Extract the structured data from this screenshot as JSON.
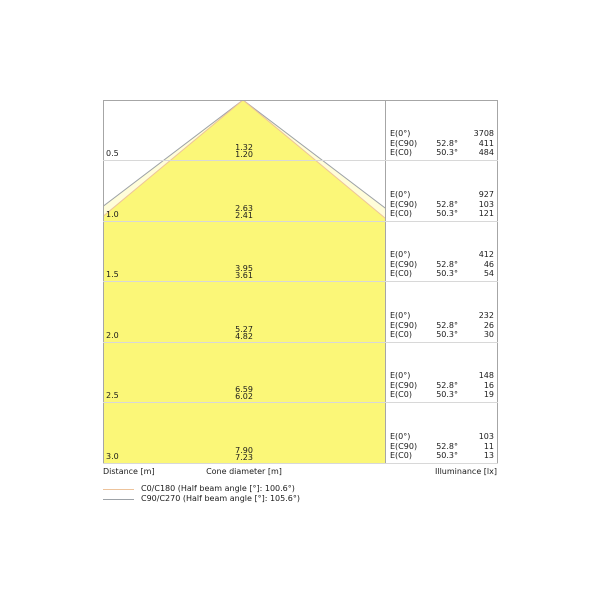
{
  "colors": {
    "cone_c90_fill": "#FFFDD9",
    "cone_c0_fill": "#FBF778",
    "c0_line": "#EDC39B",
    "c90_line": "#9DA2A7",
    "border": "#A6A6A6",
    "row_line": "#D8D8D8"
  },
  "axis": {
    "distance_label": "Distance [m]",
    "cone_diameter_label": "Cone diameter [m]",
    "illuminance_label": "Illuminance [lx]"
  },
  "e_labels": {
    "e0": "E(0°)",
    "ec90": "E(C90)",
    "ec0": "E(C0)",
    "c90_angle": "52.8°",
    "c0_angle": "50.3°"
  },
  "rows": [
    {
      "distance": "0.5",
      "cone_c90": "1.32",
      "cone_c0": "1.20",
      "e0": "3708",
      "ec90": "411",
      "ec0": "484"
    },
    {
      "distance": "1.0",
      "cone_c90": "2.63",
      "cone_c0": "2.41",
      "e0": "927",
      "ec90": "103",
      "ec0": "121"
    },
    {
      "distance": "1.5",
      "cone_c90": "3.95",
      "cone_c0": "3.61",
      "e0": "412",
      "ec90": "46",
      "ec0": "54"
    },
    {
      "distance": "2.0",
      "cone_c90": "5.27",
      "cone_c0": "4.82",
      "e0": "232",
      "ec90": "26",
      "ec0": "30"
    },
    {
      "distance": "2.5",
      "cone_c90": "6.59",
      "cone_c0": "6.02",
      "e0": "148",
      "ec90": "16",
      "ec0": "19"
    },
    {
      "distance": "3.0",
      "cone_c90": "7.90",
      "cone_c0": "7.23",
      "e0": "103",
      "ec90": "11",
      "ec0": "13"
    }
  ],
  "legend": [
    {
      "label": "C0/C180 (Half beam angle [°]: 100.6°)"
    },
    {
      "label": "C90/C270 (Half beam angle [°]: 105.6°)"
    }
  ],
  "chart_data": {
    "type": "table",
    "title": "Luminous cone diagram",
    "columns": [
      "Distance [m]",
      "Cone diameter C90/C270 [m]",
      "Cone diameter C0/C180 [m]",
      "E(0°) [lx]",
      "E(C90) 52.8° [lx]",
      "E(C0) 50.3° [lx]"
    ],
    "rows": [
      [
        0.5,
        1.32,
        1.2,
        3708,
        411,
        484
      ],
      [
        1.0,
        2.63,
        2.41,
        927,
        103,
        121
      ],
      [
        1.5,
        3.95,
        3.61,
        412,
        46,
        54
      ],
      [
        2.0,
        5.27,
        4.82,
        232,
        26,
        30
      ],
      [
        2.5,
        6.59,
        6.02,
        148,
        16,
        19
      ],
      [
        3.0,
        7.9,
        7.23,
        103,
        11,
        13
      ]
    ],
    "half_beam_angles": {
      "C0/C180": "100.6°",
      "C90/C270": "105.6°"
    },
    "legend_position": "bottom-left",
    "grid": true
  }
}
